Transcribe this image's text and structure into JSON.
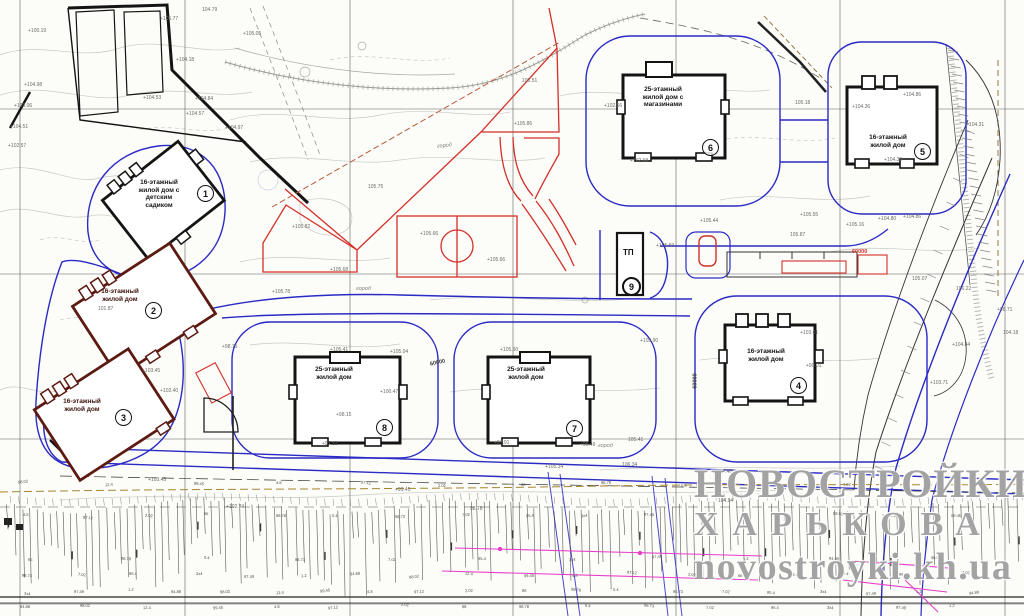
{
  "map": {
    "type": "site-plan",
    "watermark": {
      "line1": "НОВОСТРОЙКИ",
      "line2": "ХАРЬКОВА",
      "line3": "novostroyki.kh.ua"
    },
    "buildings": [
      {
        "id": "1",
        "label": "16-этажный жилой дом с детским садиком"
      },
      {
        "id": "2",
        "label": "16-этажный жилой дом"
      },
      {
        "id": "3",
        "label": "16-этажный жилой дом"
      },
      {
        "id": "4",
        "label": "16-этажный жилой дом"
      },
      {
        "id": "5",
        "label": "16-этажный жилой дом"
      },
      {
        "id": "6",
        "label": "25-этажный жилой дом с магазинами"
      },
      {
        "id": "7",
        "label": "25-этажный жилой дом"
      },
      {
        "id": "8",
        "label": "25-этажный жилой дом"
      },
      {
        "id": "9",
        "label": "ТП"
      }
    ],
    "dimension_labels": [
      {
        "text": "60000",
        "x": 852,
        "y": 249,
        "rot": 0,
        "color": "#d42f28"
      },
      {
        "text": "60000",
        "x": 430,
        "y": 360,
        "rot": -12,
        "color": "#3a3a36"
      },
      {
        "text": "60000",
        "x": 688,
        "y": 378,
        "rot": -90,
        "color": "#3a3a36"
      }
    ],
    "area_labels": [
      {
        "text": "город",
        "x": 437,
        "y": 143,
        "rot": -6
      },
      {
        "text": "город",
        "x": 356,
        "y": 286,
        "rot": 0
      },
      {
        "text": "город",
        "x": 598,
        "y": 443,
        "rot": 0
      }
    ],
    "elevation_marks": [
      {
        "t": "+100.19",
        "x": 28,
        "y": 28
      },
      {
        "t": "+104.98",
        "x": 24,
        "y": 82
      },
      {
        "t": "+103.06",
        "x": 14,
        "y": 103
      },
      {
        "t": "+104.51",
        "x": 10,
        "y": 124
      },
      {
        "t": "+102.57",
        "x": 8,
        "y": 143
      },
      {
        "t": "+105.77",
        "x": 160,
        "y": 16
      },
      {
        "t": "104.79",
        "x": 202,
        "y": 7
      },
      {
        "t": "+105.05",
        "x": 243,
        "y": 31
      },
      {
        "t": "+104.18",
        "x": 176,
        "y": 57
      },
      {
        "t": "+104.53",
        "x": 143,
        "y": 95
      },
      {
        "t": "+104.84",
        "x": 195,
        "y": 96
      },
      {
        "t": "+104.97",
        "x": 225,
        "y": 125
      },
      {
        "t": "+104.57",
        "x": 186,
        "y": 111
      },
      {
        "t": "101.87",
        "x": 98,
        "y": 306
      },
      {
        "t": "+103.45",
        "x": 142,
        "y": 368
      },
      {
        "t": "+102.40",
        "x": 160,
        "y": 388
      },
      {
        "t": "+105.82",
        "x": 292,
        "y": 224
      },
      {
        "t": "105.75",
        "x": 368,
        "y": 184
      },
      {
        "t": "+105.66",
        "x": 420,
        "y": 231
      },
      {
        "t": "+105.66",
        "x": 487,
        "y": 257
      },
      {
        "t": "+105.68",
        "x": 330,
        "y": 267
      },
      {
        "t": "105.51",
        "x": 522,
        "y": 78
      },
      {
        "t": "+105.86",
        "x": 514,
        "y": 121
      },
      {
        "t": "+105.90",
        "x": 640,
        "y": 338
      },
      {
        "t": "+105.78",
        "x": 272,
        "y": 289
      },
      {
        "t": "+98.75",
        "x": 222,
        "y": 344
      },
      {
        "t": "+105.41",
        "x": 330,
        "y": 347
      },
      {
        "t": "+105.04",
        "x": 390,
        "y": 349
      },
      {
        "t": "+100.47",
        "x": 380,
        "y": 389
      },
      {
        "t": "+98.15",
        "x": 336,
        "y": 412
      },
      {
        "t": "+97.12",
        "x": 322,
        "y": 441
      },
      {
        "t": "+105.30",
        "x": 500,
        "y": 347
      },
      {
        "t": "+97.91",
        "x": 494,
        "y": 440
      },
      {
        "t": "+96.49",
        "x": 580,
        "y": 442
      },
      {
        "t": "+105.34",
        "x": 545,
        "y": 464
      },
      {
        "t": "106.34",
        "x": 622,
        "y": 462
      },
      {
        "t": "105.41",
        "x": 628,
        "y": 437
      },
      {
        "t": "+105.59",
        "x": 656,
        "y": 243
      },
      {
        "t": "+105.44",
        "x": 700,
        "y": 218
      },
      {
        "t": "+105.55",
        "x": 800,
        "y": 212
      },
      {
        "t": "105.87",
        "x": 790,
        "y": 232
      },
      {
        "t": "+105.16",
        "x": 846,
        "y": 222
      },
      {
        "t": "+104.80",
        "x": 878,
        "y": 216
      },
      {
        "t": "+104.86",
        "x": 903,
        "y": 214
      },
      {
        "t": "+102.68",
        "x": 630,
        "y": 158
      },
      {
        "t": "+102.56",
        "x": 604,
        "y": 103
      },
      {
        "t": "+104.86",
        "x": 903,
        "y": 92
      },
      {
        "t": "+104.36",
        "x": 852,
        "y": 104
      },
      {
        "t": "+104.39",
        "x": 884,
        "y": 157
      },
      {
        "t": "+104.31",
        "x": 966,
        "y": 122
      },
      {
        "t": "+103.01",
        "x": 800,
        "y": 330
      },
      {
        "t": "+99.01",
        "x": 806,
        "y": 363
      },
      {
        "t": "105.07",
        "x": 912,
        "y": 276
      },
      {
        "t": "106.22",
        "x": 956,
        "y": 286
      },
      {
        "t": "+104.84",
        "x": 952,
        "y": 342
      },
      {
        "t": "+98.71",
        "x": 997,
        "y": 307
      },
      {
        "t": "104.18",
        "x": 1003,
        "y": 330
      },
      {
        "t": "+103.45",
        "x": 148,
        "y": 477
      },
      {
        "t": "+102.74",
        "x": 226,
        "y": 504
      },
      {
        "t": "+105.48",
        "x": 714,
        "y": 469
      },
      {
        "t": "104.94",
        "x": 718,
        "y": 498
      },
      {
        "t": "+99.45",
        "x": 395,
        "y": 487
      },
      {
        "t": "98.78",
        "x": 470,
        "y": 506
      },
      {
        "t": "+103.71",
        "x": 930,
        "y": 380
      },
      {
        "t": "105.18",
        "x": 795,
        "y": 100
      }
    ],
    "colors": {
      "road_blue": "#2a2ac4",
      "planning_red": "#d42f28",
      "building_outline": "#141414",
      "existing_red_brown": "#5c1a12",
      "utility_magenta": "#e83cc8",
      "slope_olive": "#a8852f",
      "watermark_gray": "#787878"
    }
  }
}
